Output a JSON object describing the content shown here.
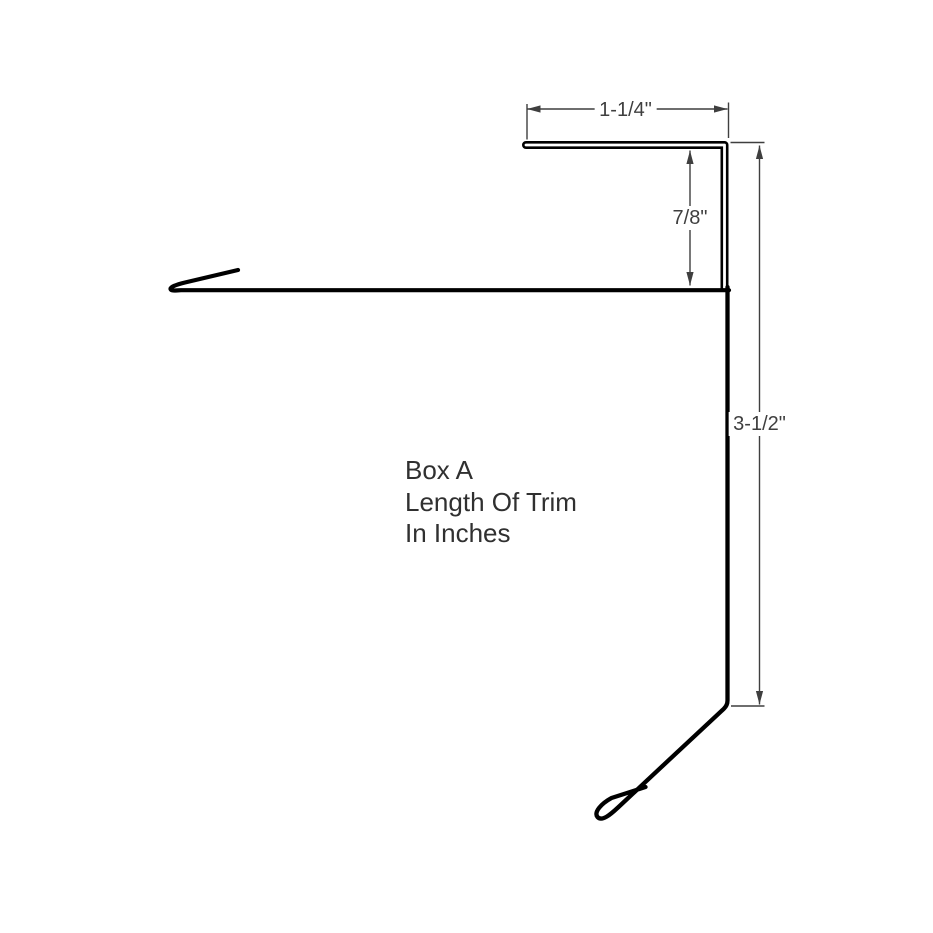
{
  "colors": {
    "trim": "#000000",
    "dimension": "#3f3f3f",
    "background": "#ffffff"
  },
  "dims": {
    "top": {
      "label": "1-1/4\""
    },
    "face": {
      "label": "7/8\""
    },
    "overall": {
      "label": "3-1/2\""
    }
  },
  "note": {
    "lines": [
      "Box A",
      "Length Of Trim",
      "In Inches"
    ]
  }
}
